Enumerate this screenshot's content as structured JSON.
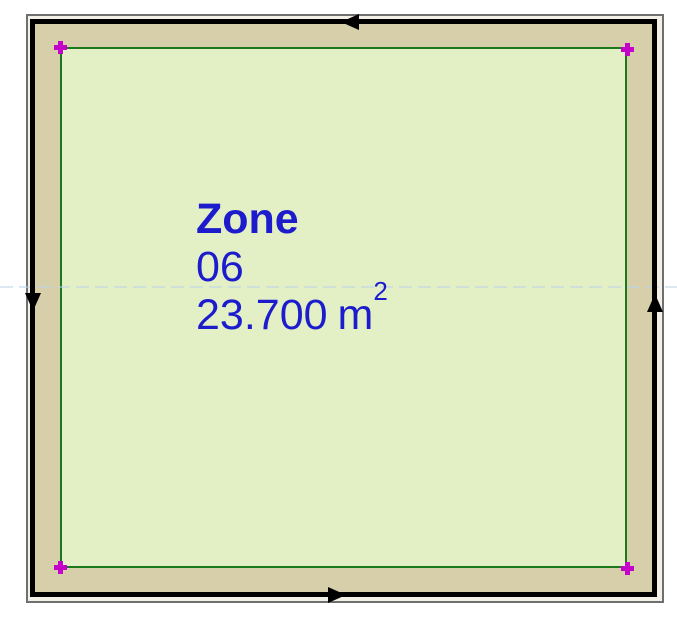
{
  "drawing": {
    "zone_stamp": {
      "name": "Zone",
      "number": "06",
      "area": "23.700",
      "unit": "m",
      "unit_exponent": "2"
    },
    "corner_nodes": [
      {
        "position": "top-left"
      },
      {
        "position": "top-right"
      },
      {
        "position": "bottom-left"
      },
      {
        "position": "bottom-right"
      }
    ],
    "wall_direction_arrows": [
      {
        "edge": "top",
        "direction": "left"
      },
      {
        "edge": "left",
        "direction": "down"
      },
      {
        "edge": "bottom",
        "direction": "right"
      },
      {
        "edge": "right",
        "direction": "up"
      }
    ],
    "colors": {
      "zone_fill": "#e3f0c6",
      "zone_boundary": "#1c781c",
      "wall_fill": "#d6cfaa",
      "wall_outline": "#000000",
      "label_text": "#1c1ccd",
      "corner_node": "#c303c9",
      "paper_border": "#6f6f6f",
      "guide_line": "#bdd4e7",
      "background": "#ffffff"
    }
  }
}
